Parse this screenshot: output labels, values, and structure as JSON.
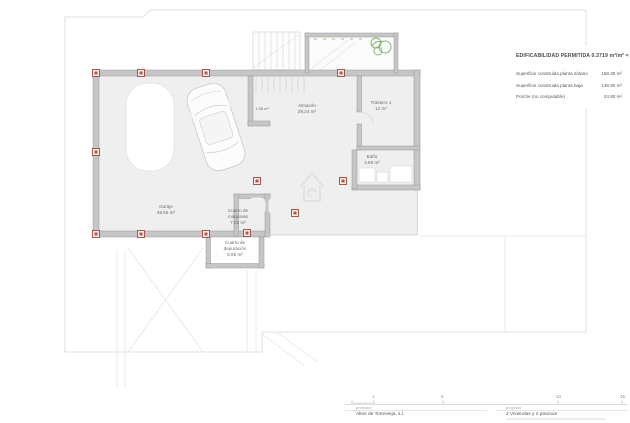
{
  "title_block": {
    "title": "EDIFICABILIDAD PERMITIDA 0.3719 m²/m² = 148.",
    "rows": [
      {
        "label": "Superficie construida planta sótano",
        "value": "168.39 m²"
      },
      {
        "label": "Superficie construida planta baja",
        "value": "139.80 m²"
      },
      {
        "label": "Porche (no computable)",
        "value": "24.80 m²"
      }
    ]
  },
  "plan": {
    "floor_name": "planta sótano",
    "rooms": {
      "garaje": "Garaje\n38.65 m²",
      "under_stairs": "1.08 m²",
      "almacen": "Almacén\n29.24 m²",
      "trastero": "Trastero 1\n12 m²",
      "bano": "Baño\n4.88 m²",
      "maquinas": "Cuarto de\nmáquinas\n7.05 m²",
      "depuracion": "Cuarto de\ndepuración\n5.85 m²"
    }
  },
  "scale_bar": {
    "ticks": [
      "1",
      "5",
      "10",
      "15"
    ]
  },
  "footer": {
    "promotor_label": "promotor",
    "promotor_value": "Altos de Torrevieja, s.l.",
    "proyecto_label": "proyecto",
    "proyecto_value": "2 Viviendas y 2 piscinas"
  },
  "colors": {
    "wall": "#c6c6c6",
    "pillar": "#a8564c",
    "plant": "#86b576",
    "boundary": "#d9d9d9"
  }
}
